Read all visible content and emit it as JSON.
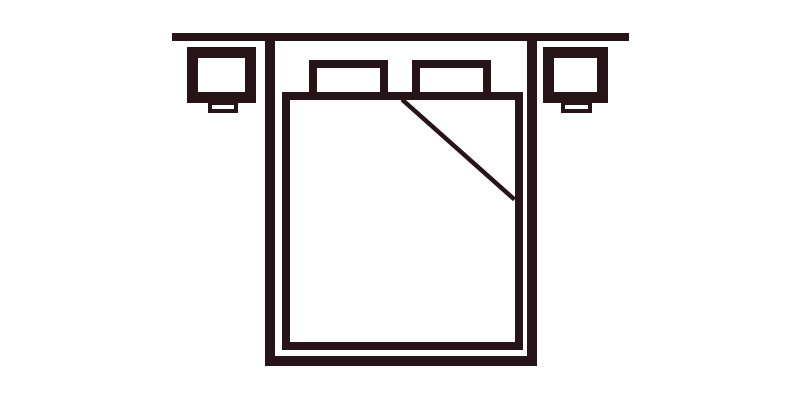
{
  "figure": {
    "name": "double-bed-top-view-with-nightstands",
    "description": "Line-art floor plan icon of a double bed against a wall: bed frame, mattress, two pillows, folded blanket corner, and a bedside table on each side of the bed",
    "colors": {
      "stroke": "#261418",
      "background": "#ffffff"
    },
    "parts": [
      {
        "name": "wall-line"
      },
      {
        "name": "bed-frame-outline"
      },
      {
        "name": "mattress-outline"
      },
      {
        "name": "pillow-left"
      },
      {
        "name": "pillow-right"
      },
      {
        "name": "blanket-fold-line"
      },
      {
        "name": "nightstand-left"
      },
      {
        "name": "nightstand-left-foot"
      },
      {
        "name": "nightstand-right"
      },
      {
        "name": "nightstand-right-foot"
      }
    ]
  }
}
